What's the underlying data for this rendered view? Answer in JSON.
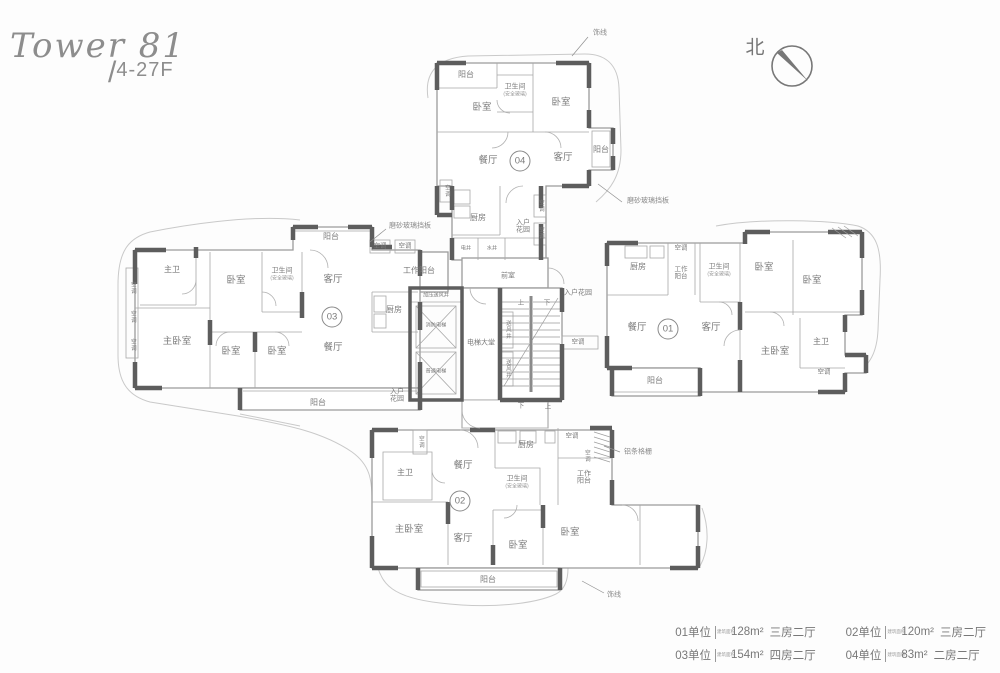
{
  "title": {
    "tower": "Tower 81",
    "floors_slash": "/",
    "floors": "4-27F"
  },
  "compass": {
    "north": "北"
  },
  "rooms": {
    "balcony": "阳台",
    "bedroom": "卧室",
    "master_bedroom": "主卧室",
    "master_bath": "主卫",
    "bathroom": "卫生间",
    "bathroom_note": "(安全玻璃)",
    "dining": "餐厅",
    "living": "客厅",
    "kitchen": "厨房",
    "entry_garden": "入户花园",
    "work_balcony": "工作阳台",
    "elevator_lobby": "电梯大堂",
    "fire_elevator": "消防电梯",
    "regular_elevator": "普通电梯",
    "pressure_shaft": "加压送风井",
    "air_shaft": "送风井",
    "anteroom": "前室",
    "elec_shaft": "电井",
    "water_shaft": "水井",
    "ac": "空调",
    "up": "上",
    "down": "下"
  },
  "units": {
    "u01": "01",
    "u02": "02",
    "u03": "03",
    "u04": "04"
  },
  "annotations": {
    "trim_line": "饰线",
    "frosted_glass": "磨砂玻璃挡板",
    "alum_grille": "铝条格栅"
  },
  "legend": {
    "area_label": "建筑面积",
    "entries": [
      {
        "unit": "01单位",
        "area": "128m²",
        "type": "三房二厅"
      },
      {
        "unit": "02单位",
        "area": "120m²",
        "type": "三房二厅"
      },
      {
        "unit": "03单位",
        "area": "154m²",
        "type": "四房二厅"
      },
      {
        "unit": "04单位",
        "area": "83m²",
        "type": "二房二厅"
      }
    ]
  }
}
